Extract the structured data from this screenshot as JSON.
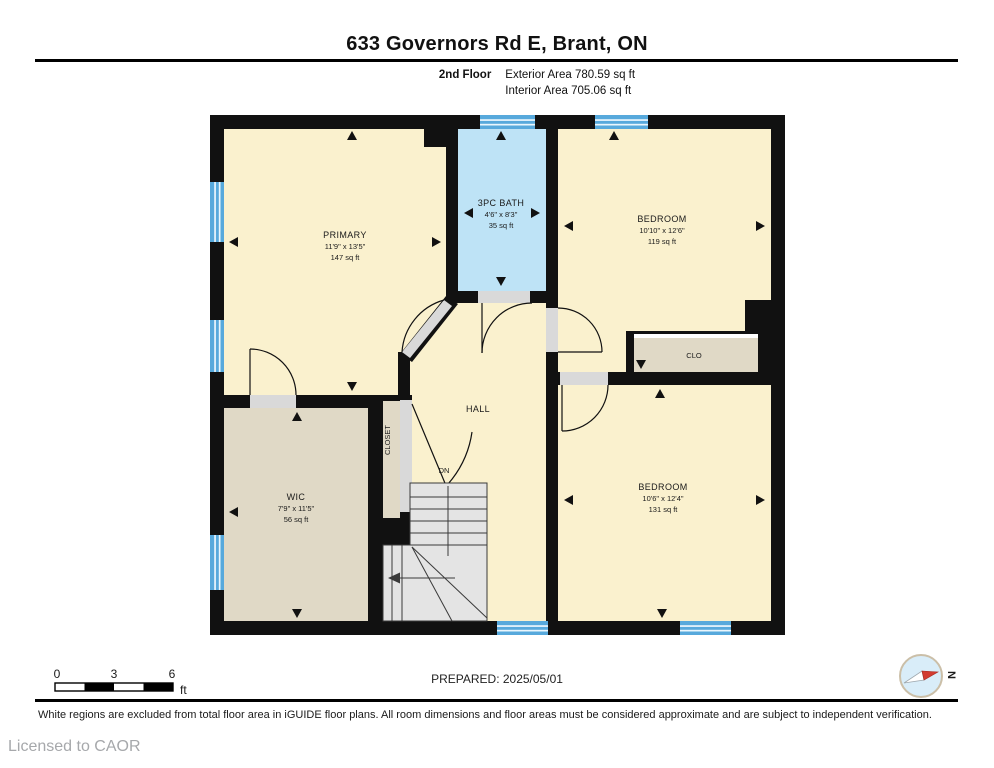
{
  "header": {
    "title": "633 Governors Rd E, Brant, ON",
    "floor_label": "2nd Floor",
    "exterior_area": "Exterior Area 780.59 sq ft",
    "interior_area": "Interior Area 705.06 sq ft"
  },
  "plan": {
    "rooms": {
      "primary": {
        "name": "PRIMARY",
        "dims": "11'9\" x 13'5\"",
        "area": "147 sq ft"
      },
      "bath": {
        "name": "3PC BATH",
        "dims": "4'6\" x 8'3\"",
        "area": "35 sq ft"
      },
      "bedroom_top": {
        "name": "BEDROOM",
        "dims": "10'10\" x 12'6\"",
        "area": "119 sq ft"
      },
      "bedroom_bottom": {
        "name": "BEDROOM",
        "dims": "10'6\" x 12'4\"",
        "area": "131 sq ft"
      },
      "wic": {
        "name": "WIC",
        "dims": "7'9\" x 11'5\"",
        "area": "56 sq ft"
      },
      "hall": {
        "name": "HALL"
      },
      "closet": {
        "name": "CLOSET"
      },
      "clo": {
        "name": "CLO"
      },
      "stairs_label": "DN"
    },
    "compass": {
      "label": "N"
    }
  },
  "footer": {
    "scale_bar": {
      "tick_0": "0",
      "tick_3": "3",
      "tick_6": "6",
      "unit": "ft"
    },
    "prepared": "PREPARED: 2025/05/01",
    "disclaimer": "White regions are excluded from total floor area in iGUIDE floor plans. All room dimensions and floor areas must be considered approximate and are subject to independent verification.",
    "licensed": "Licensed to CAOR"
  },
  "colors": {
    "wall": "#111111",
    "room_fill": "#FAF1CE",
    "closet_fill": "#E0D9C6",
    "bath_fill": "#BEE3F6",
    "window_blue": "#57A9DC",
    "stairs_fill": "#E4E4E4",
    "door_gap": "#D9D9D9",
    "compass_red": "#D23B30"
  }
}
